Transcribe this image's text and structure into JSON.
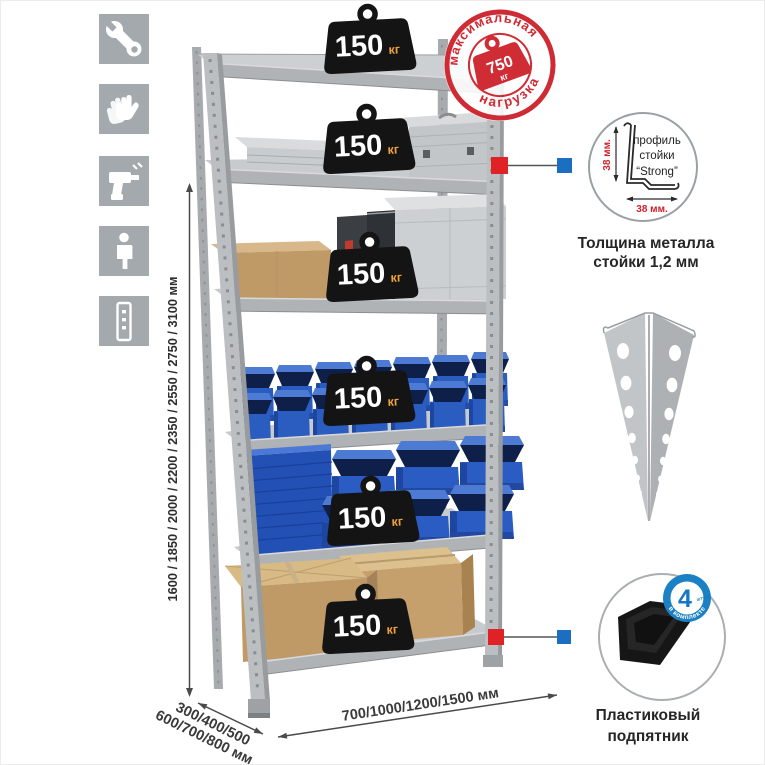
{
  "title": "Metal shelving rack infographic",
  "icons": [
    {
      "name": "wrench"
    },
    {
      "name": "gloves"
    },
    {
      "name": "drill"
    },
    {
      "name": "person"
    },
    {
      "name": "rack-post"
    }
  ],
  "dimensions": {
    "height_label": "1600 / 1850 / 2000 / 2200 / 2350 / 2550 / 2750 / 3100 мм",
    "depth_label_line1": "300/400/500",
    "depth_label_line2": "600/700/800 мм",
    "width_label": "700/1000/1200/1500 мм"
  },
  "shelf_load": {
    "value": "150",
    "unit": "кг"
  },
  "max_load_stamp": {
    "arc_top": "максимальная",
    "arc_bottom": "нагрузка",
    "value": "750",
    "unit": "кг"
  },
  "profile_detail": {
    "line1": "профиль",
    "line2": "стойки",
    "line3": "“Strong”",
    "dim_vertical": "38 мм.",
    "dim_horizontal": "38 мм.",
    "caption_line1": "Толщина металла",
    "caption_line2": "стойки 1,2 мм"
  },
  "foot_detail": {
    "badge_value": "4",
    "badge_note": "штуки",
    "badge_arc": "в комплекте",
    "caption_line1": "Пластиковый",
    "caption_line2": "подпятник"
  },
  "colors": {
    "accent_red": "#e02227",
    "accent_blue": "#1c6fc0",
    "stamp_red": "#cf2b34",
    "bin_blue": "#2b5cc0",
    "metal_gray": "#b9bcbf",
    "icon_bg": "#a4a9ae",
    "badge_black": "#141414",
    "unit_orange": "#f0a23a",
    "cardboard": "#c29a68"
  }
}
